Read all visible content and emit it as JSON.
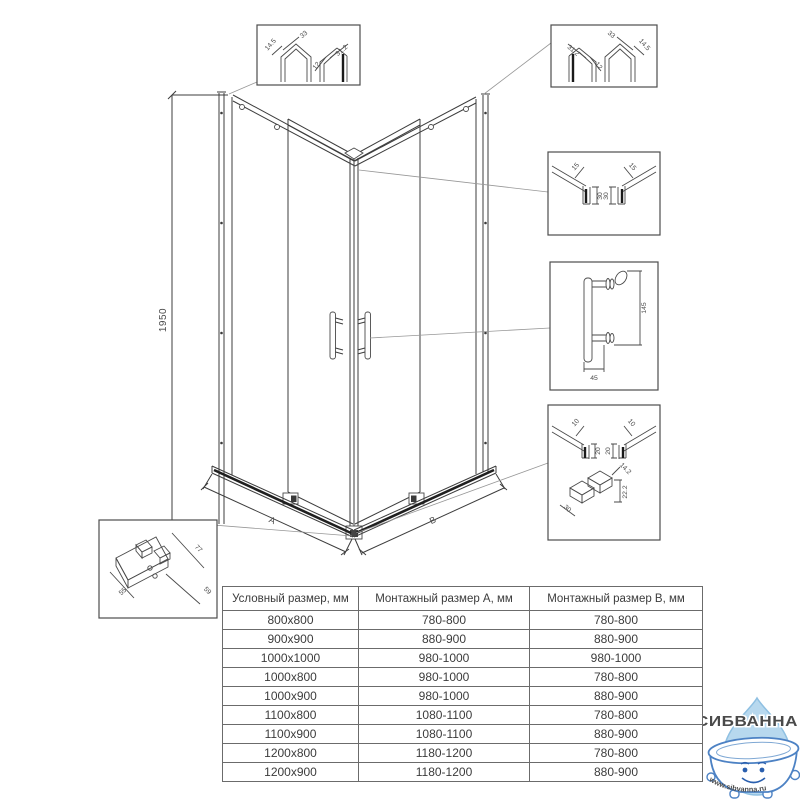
{
  "drawing": {
    "height": "1950",
    "dim_a": "A",
    "dim_b": "B"
  },
  "details": {
    "top_left": {
      "d1": "14.5",
      "d2": "33",
      "d3": "12",
      "d4": "31.2"
    },
    "top_right": {
      "d1": "31.2",
      "d2": "12",
      "d3": "33",
      "d4": "14.5"
    },
    "mid_right": {
      "d1": "15",
      "d2": "30",
      "d3": "15",
      "d4": "30"
    },
    "handle": {
      "d1": "145",
      "d2": "45"
    },
    "bottom_right": {
      "d1": "10",
      "d2": "20",
      "d3": "10",
      "d4": "20",
      "d5": "14.2",
      "d6": "22.2",
      "d7": "30"
    },
    "bottom_left": {
      "d1": "55",
      "d2": "77",
      "d3": "59"
    }
  },
  "table": {
    "headers": [
      "Условный размер, мм",
      "Монтажный размер A, мм",
      "Монтажный размер B, мм"
    ],
    "rows": [
      [
        "800x800",
        "780-800",
        "780-800"
      ],
      [
        "900x900",
        "880-900",
        "880-900"
      ],
      [
        "1000x1000",
        "980-1000",
        "980-1000"
      ],
      [
        "1000x800",
        "980-1000",
        "780-800"
      ],
      [
        "1000x900",
        "980-1000",
        "880-900"
      ],
      [
        "1100x800",
        "1080-1100",
        "780-800"
      ],
      [
        "1100x900",
        "1080-1100",
        "880-900"
      ],
      [
        "1200x800",
        "1180-1200",
        "780-800"
      ],
      [
        "1200x900",
        "1180-1200",
        "880-900"
      ]
    ]
  },
  "logo": {
    "brand": "СИБВАННА",
    "url": "www.sibvanna.ru",
    "brand_color": "#4d82c4",
    "drop_fill": "#b7d8ee",
    "drop_stroke": "#8fc0e2"
  }
}
